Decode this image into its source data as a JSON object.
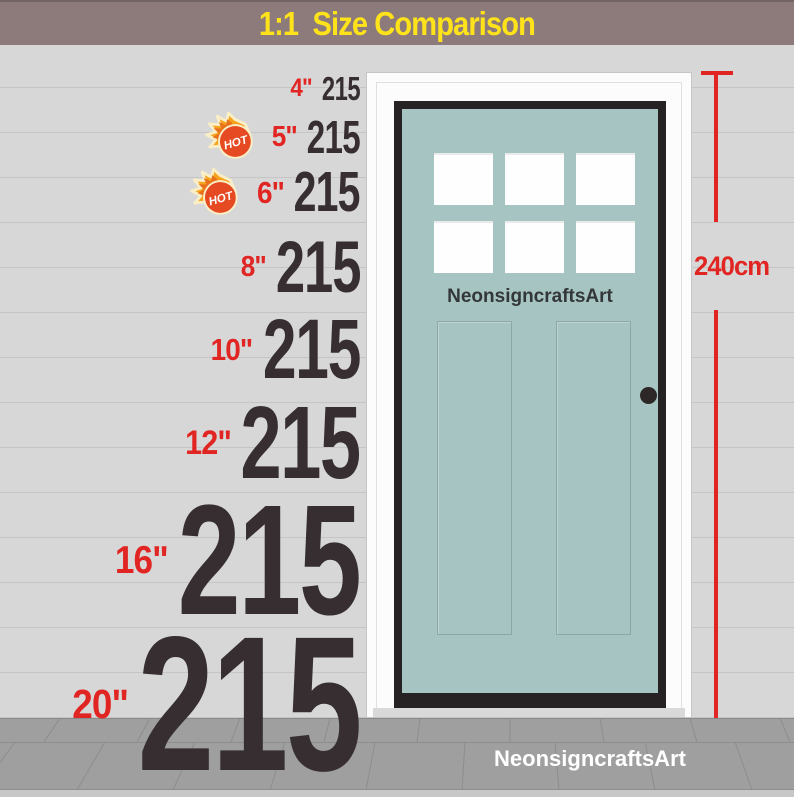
{
  "banner": {
    "title": "1:1  Size Comparison"
  },
  "rows": [
    {
      "size_label": "4\"",
      "value": "215",
      "hot": false
    },
    {
      "size_label": "5\"",
      "value": "215",
      "hot": true
    },
    {
      "size_label": "6\"",
      "value": "215",
      "hot": true
    },
    {
      "size_label": "8\"",
      "value": "215",
      "hot": false
    },
    {
      "size_label": "10\"",
      "value": "215",
      "hot": false
    },
    {
      "size_label": "12\"",
      "value": "215",
      "hot": false
    },
    {
      "size_label": "16\"",
      "value": "215",
      "hot": false
    },
    {
      "size_label": "20\"",
      "value": "215",
      "hot": false
    }
  ],
  "hot_badge": {
    "label": "HOT"
  },
  "door": {
    "brand": "NeonsigncraftsArt",
    "height_label": "240cm",
    "window_count": 6
  },
  "floor": {
    "brand": "NeonsigncraftsArt"
  },
  "colors": {
    "wall": "#d7d7d7",
    "wall_line": "#c5c5c5",
    "banner": "#8d7b7b",
    "yellow": "#ffe31a",
    "red": "#e02522",
    "ink": "#362e30",
    "teal": "#a6c4c1",
    "door_black": "#262122",
    "frame": "#fcfcfc",
    "floor": "#9f9f9f",
    "floor_line": "#8d8d8d",
    "floor_strip": "#c7c7c7"
  }
}
